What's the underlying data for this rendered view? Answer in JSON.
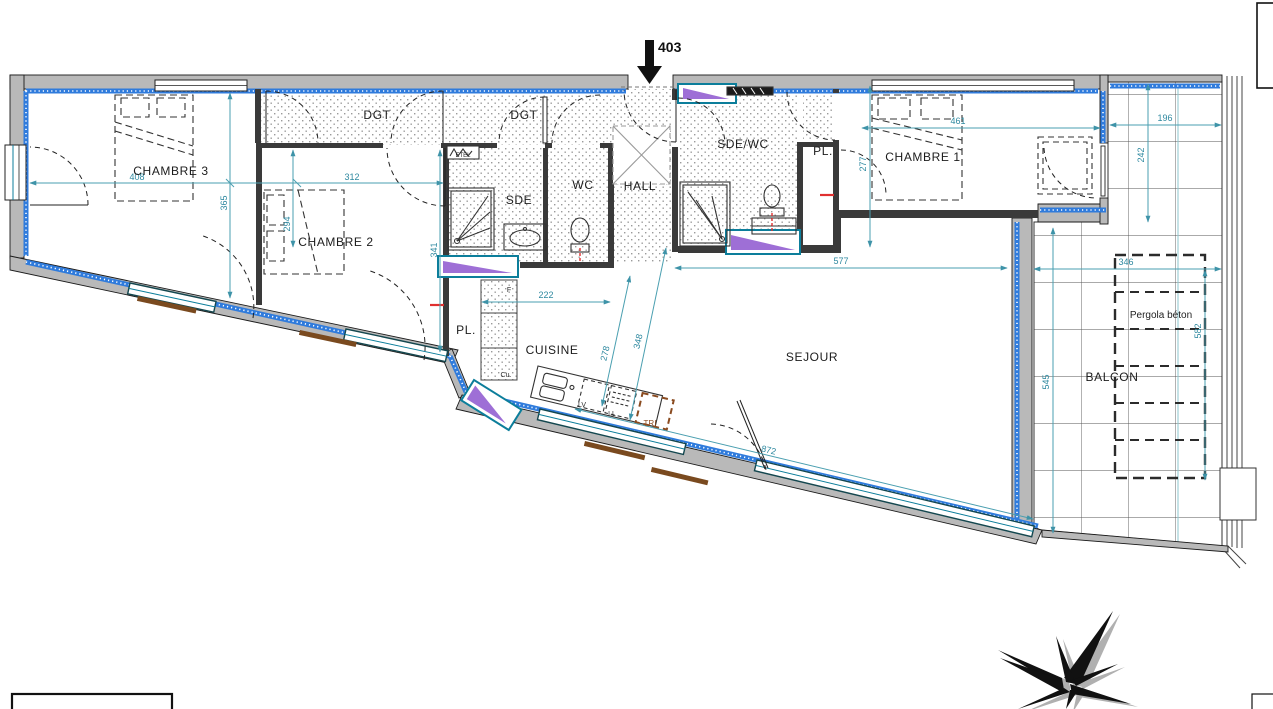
{
  "plan": {
    "apartment_number": "403",
    "rooms": {
      "chambre3": "CHAMBRE 3",
      "chambre2": "CHAMBRE 2",
      "chambre1": "CHAMBRE 1",
      "dgt": "DGT",
      "sde": "SDE",
      "wc": "WC",
      "hall": "HALL",
      "sde_wc": "SDE/WC",
      "pl": "PL.",
      "cuisine": "CUISINE",
      "sejour": "SEJOUR",
      "balcon": "BALCON",
      "pergola": "Pergola béton"
    },
    "equipment": {
      "etel": "ETEL",
      "fridge": "F",
      "cooking": "Cu.",
      "dishwasher": "LV",
      "washer": "LL",
      "waste": "TRI"
    },
    "dimensions_cm": {
      "chambre3_width": "408",
      "chambre3_depth": "365",
      "chambre2_width": "312",
      "chambre2_depth": "294",
      "chambre2_east_depth": "341",
      "cuisine_width": "222",
      "cuisine_depth": "278",
      "cuisine_facade_depth": "348",
      "sejour_width": "577",
      "sejour_facade_length": "872",
      "chambre1_width": "461",
      "chambre1_depth": "277",
      "balcon_top_width": "196",
      "balcon_top_depth": "242",
      "balcon_width": "346",
      "balcon_depth": "545",
      "balcon_right_depth": "582"
    },
    "colors": {
      "dimension_line": "#4a9fb0",
      "dimension_text": "#2f89a0",
      "wall_fill": "#b9b9b9",
      "insulation_blue": "#2f7bdc",
      "window_frame": "#0c7e9b",
      "sill_purple": "#9e6fd6",
      "waste_brown": "#8a4b20"
    }
  }
}
